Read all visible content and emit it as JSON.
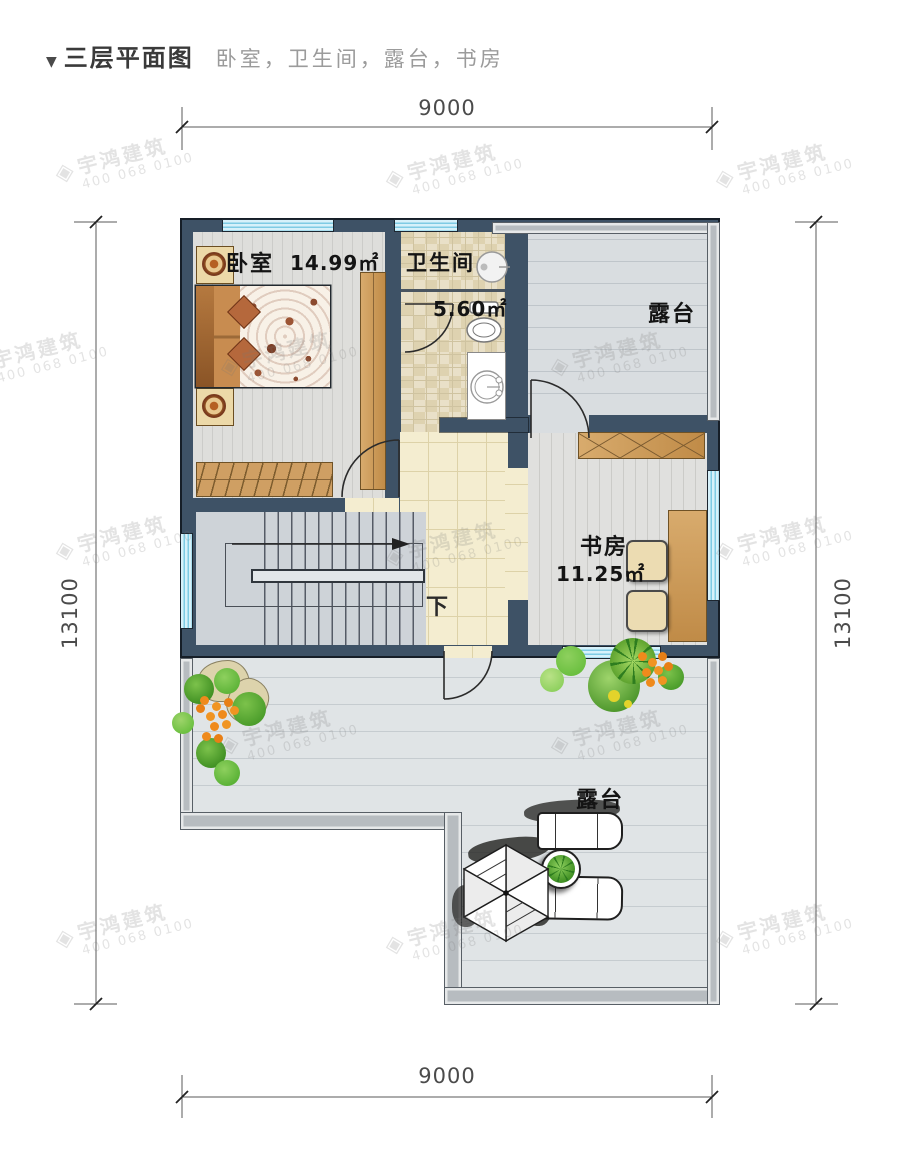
{
  "header": {
    "marker": "▼",
    "title": "三层平面图",
    "subtitle": "卧室，卫生间，露台，书房"
  },
  "dimensions": {
    "top": "9000",
    "bottom": "9000",
    "left": "13100",
    "right": "13100"
  },
  "rooms": {
    "bedroom": {
      "name": "卧室",
      "area": "14.99㎡"
    },
    "bathroom": {
      "name": "卫生间",
      "area": "5.60㎡"
    },
    "study": {
      "name": "书房",
      "area": "11.25㎡"
    },
    "terrace_top": {
      "name": "露台"
    },
    "terrace_bottom": {
      "name": "露台"
    },
    "stairs": {
      "down": "下"
    }
  },
  "watermark": {
    "logo": "◈",
    "line1": "宇鸿建筑",
    "line2": "400 068 0100"
  },
  "colors": {
    "wall": "#3e5266",
    "window": "#d6f1fa",
    "window_stripe": "#7ecbe4",
    "wood": "#d2a368",
    "parapet": "#b7bcc0",
    "hall_floor": "#f4edd0",
    "bath_floor": "#e9e0c8",
    "terrace_floor": "#e0e4e6",
    "plant_green": "#4a9c2a",
    "flower_orange": "#ef8a1c"
  }
}
